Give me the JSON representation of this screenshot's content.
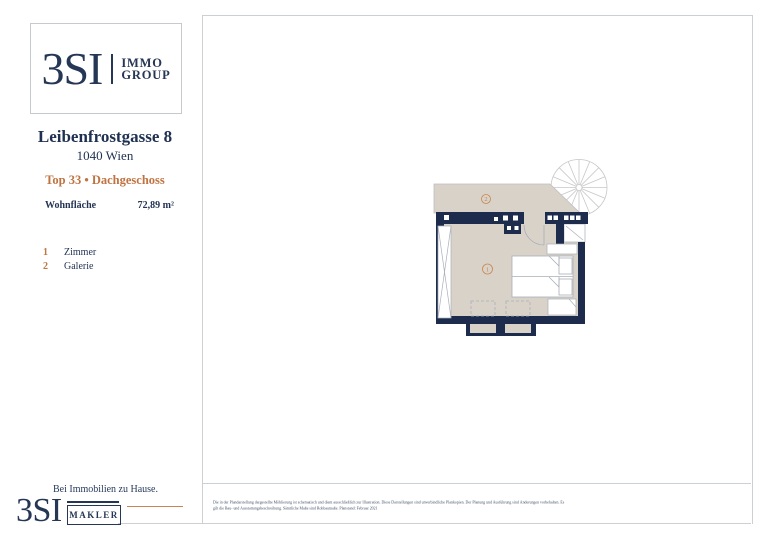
{
  "colors": {
    "brand_navy": "#263655",
    "wall_navy": "#1d2b4d",
    "floor_beige": "#d9d2c9",
    "accent_orange": "#c0763d",
    "frame_gray": "#ccd0d5",
    "furniture_stroke": "#a9afb8"
  },
  "sidebar": {
    "logo": {
      "brand": "3SI",
      "word1": "IMMO",
      "word2": "GROUP"
    },
    "address_line1": "Leibenfrostgasse 8",
    "address_line2": "1040 Wien",
    "unit_line": "Top 33 • Dachgeschoss",
    "area_label": "Wohnfläche",
    "area_value": "72,89 m²",
    "legend": [
      {
        "num": "1",
        "label": "Zimmer"
      },
      {
        "num": "2",
        "label": "Galerie"
      }
    ]
  },
  "plan": {
    "room1_label": "1",
    "room2_label": "2"
  },
  "footer": {
    "tagline": "Bei Immobilien zu Hause.",
    "logo_brand": "3SI",
    "logo_word": "MAKLER",
    "disclaimer_line1": "Die in der Plandarstellung dargestellte Möblierung ist schematisch und dient ausschließlich zur Illustration. Diese Darstellungen sind unverbindliche Plankopien. Der Planung und Ausführung sind Änderungen vorbehalten. Es",
    "disclaimer_line2": "gilt die Bau- und Ausstattungsbeschreibung. Sämtliche Maße sind Rohbaumaße. Planstand: Februar 2021"
  }
}
